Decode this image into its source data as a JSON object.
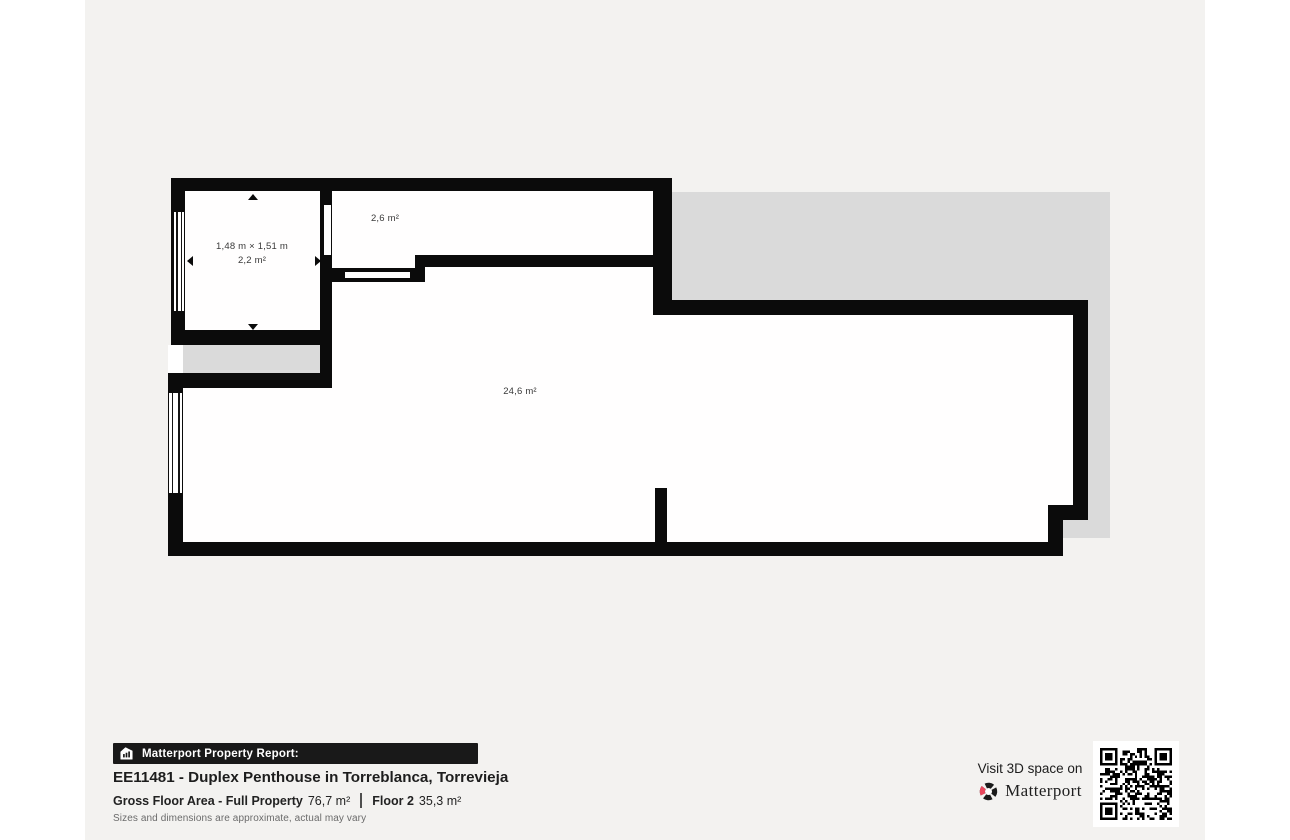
{
  "floorplan": {
    "room_small": {
      "dims": "1,48 m × 1,51 m",
      "area": "2,2 m²"
    },
    "room_hall": {
      "area": "2,6 m²"
    },
    "room_main": {
      "area": "24,6 m²"
    },
    "colors": {
      "wall": "#0b0b0b",
      "room": "#ffffff",
      "terrace": "#dadada",
      "background": "#f3f2f0"
    }
  },
  "footer": {
    "banner_label": "Matterport Property Report:",
    "title": "EE11481 - Duplex Penthouse in Torreblanca, Torrevieja",
    "stats": {
      "gross_label": "Gross Floor Area - Full Property",
      "gross_value": "76,7 m²",
      "floor_label": "Floor 2",
      "floor_value": "35,3 m²"
    },
    "disclaimer": "Sizes and dimensions are approximate, actual may vary"
  },
  "cta": {
    "visit_text": "Visit 3D space on",
    "brand": "Matterport",
    "brand_red": "#e9475d"
  }
}
